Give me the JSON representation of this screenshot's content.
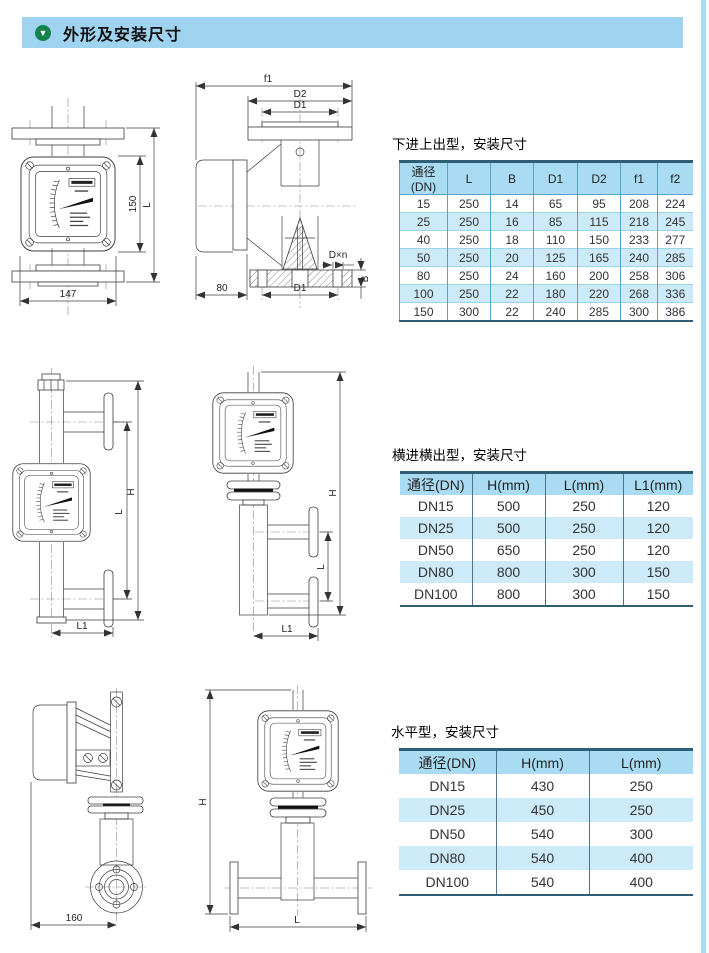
{
  "header": {
    "title": "外形及安装尺寸",
    "bar_color": "#9fd4f1",
    "icon": "down-triangle-icon",
    "icon_color": "#15834d"
  },
  "sections": [
    {
      "table_title": "下进上出型，安装尺寸",
      "table": {
        "headers": [
          "通径(DN)",
          "L",
          "B",
          "D1",
          "D2",
          "f1",
          "f2"
        ],
        "rows": [
          [
            "15",
            "250",
            "14",
            "65",
            "95",
            "208",
            "224"
          ],
          [
            "25",
            "250",
            "16",
            "85",
            "115",
            "218",
            "245"
          ],
          [
            "40",
            "250",
            "18",
            "110",
            "150",
            "233",
            "277"
          ],
          [
            "50",
            "250",
            "20",
            "125",
            "165",
            "240",
            "285"
          ],
          [
            "80",
            "250",
            "24",
            "160",
            "200",
            "258",
            "306"
          ],
          [
            "100",
            "250",
            "22",
            "180",
            "220",
            "268",
            "336"
          ],
          [
            "150",
            "300",
            "22",
            "240",
            "285",
            "300",
            "386"
          ]
        ]
      },
      "drawing_labels": {
        "front_height": "150",
        "front_total_height": "L",
        "front_width": "147",
        "top_width": "f1",
        "flange_od": "D2",
        "bolt_circle_top": "D1",
        "depth": "80",
        "bolt_circle_bottom": "D1",
        "bolt_holes": "D×n",
        "flange_thickness": "B"
      }
    },
    {
      "table_title": "横进横出型，安装尺寸",
      "table": {
        "headers": [
          "通径(DN)",
          "H(mm)",
          "L(mm)",
          "L1(mm)"
        ],
        "rows": [
          [
            "DN15",
            "500",
            "250",
            "120"
          ],
          [
            "DN25",
            "500",
            "250",
            "120"
          ],
          [
            "DN50",
            "650",
            "250",
            "120"
          ],
          [
            "DN80",
            "800",
            "300",
            "150"
          ],
          [
            "DN100",
            "800",
            "300",
            "150"
          ]
        ]
      },
      "drawing_labels": {
        "left_H": "H",
        "left_L": "L",
        "left_L1": "L1",
        "right_H": "H",
        "right_L": "L",
        "right_L1": "L1"
      }
    },
    {
      "table_title": "水平型，安装尺寸",
      "table": {
        "headers": [
          "通径(DN)",
          "H(mm)",
          "L(mm)"
        ],
        "rows": [
          [
            "DN15",
            "430",
            "250"
          ],
          [
            "DN25",
            "450",
            "250"
          ],
          [
            "DN50",
            "540",
            "300"
          ],
          [
            "DN80",
            "540",
            "400"
          ],
          [
            "DN100",
            "540",
            "400"
          ]
        ]
      },
      "drawing_labels": {
        "side_width": "160",
        "front_H": "H",
        "front_L": "L"
      }
    }
  ]
}
